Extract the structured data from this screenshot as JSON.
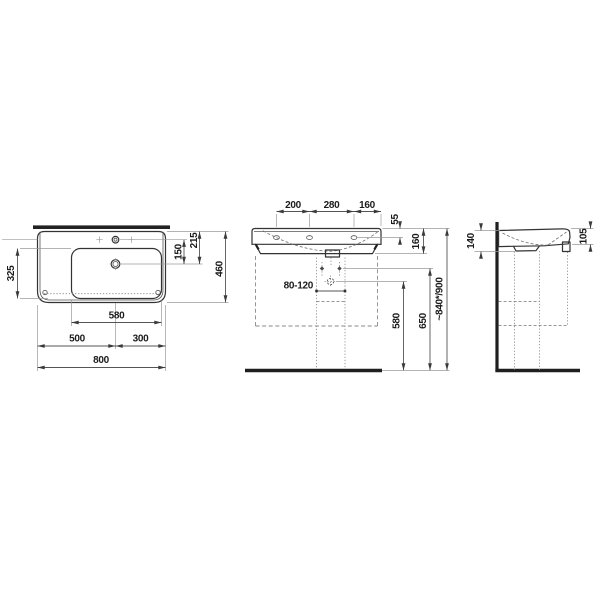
{
  "drawing": {
    "title_semantic": "washbasin technical dimension drawing, three views",
    "background_color": "#ffffff",
    "line_color": "#333333",
    "top_view": {
      "bowl_depth": "325",
      "tap_to_drain": "150",
      "rear_to_drain": "215",
      "total_depth": "460",
      "bowl_width": "580",
      "left_to_drain": "500",
      "drain_to_right": "300",
      "total_width": "800"
    },
    "front_view": {
      "tap_spacing_left": "200",
      "tap_spacing_center": "280",
      "tap_spacing_right": "160",
      "rim_to_tapholes": "55",
      "ceramic_height": "160",
      "trap_offset_range": "80-120",
      "drain_outlet_height": "580",
      "fixing_holes_height": "650",
      "installation_height": "~840*/900"
    },
    "side_view": {
      "height_at_wall": "140",
      "front_edge_height": "105"
    }
  }
}
